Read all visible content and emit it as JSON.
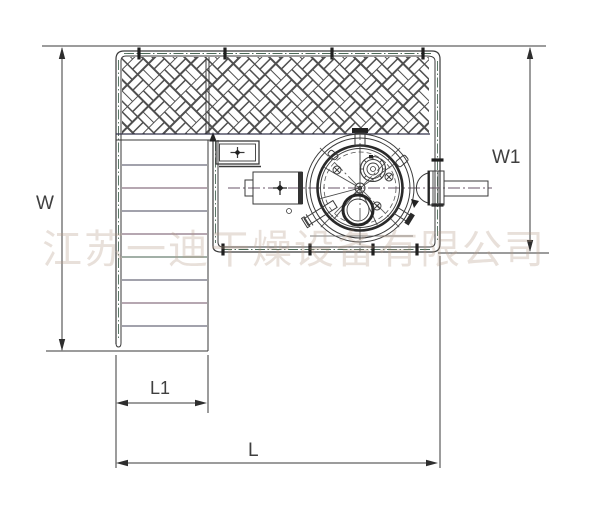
{
  "meta": {
    "type": "engineering-drawing",
    "description": "Top view plan of a drying machine on an operating platform with grating, stairs and overall dimension callouts"
  },
  "dimension_labels": {
    "w": "W",
    "w1": "W1",
    "l1": "L1",
    "l": "L"
  },
  "watermark": {
    "text": "江苏一迪干燥设备有限公司",
    "color": "#b59c88"
  },
  "colors": {
    "background": "#ffffff",
    "main_line": "#3a3a3a",
    "bold_line": "#222222",
    "centerline_green": "#4c6b58",
    "rung_purple": "#6d4f63",
    "rung_blue": "#45455a",
    "hatch_stroke": "#4f4f4f"
  }
}
